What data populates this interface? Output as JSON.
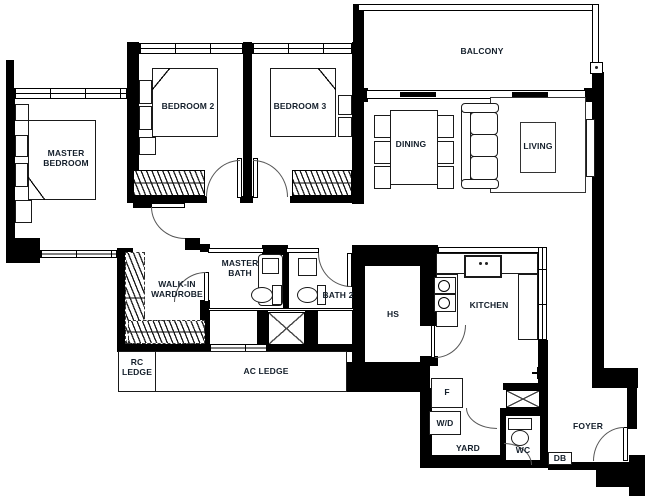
{
  "title": "3-bedroom apartment floor plan",
  "colors": {
    "wall": "#000000",
    "text": "#141f2b",
    "door_arc": "#555555",
    "background": "#ffffff"
  },
  "labels": {
    "balcony": "BALCONY",
    "bedroom2": "BEDROOM 2",
    "bedroom3": "BEDROOM 3",
    "master_bedroom": "MASTER\nBEDROOM",
    "dining": "DINING",
    "living": "LIVING",
    "walk_in_wardrobe": "WALK-IN\nWARDROBE",
    "master_bath": "MASTER\nBATH",
    "bath2": "BATH 2",
    "hs": "HS",
    "kitchen": "KITCHEN",
    "rc_ledge": "RC\nLEDGE",
    "ac_ledge": "AC LEDGE",
    "fridge": "F",
    "washer_dryer": "W/D",
    "yard": "YARD",
    "wc": "WC",
    "db": "DB",
    "foyer": "FOYER"
  }
}
